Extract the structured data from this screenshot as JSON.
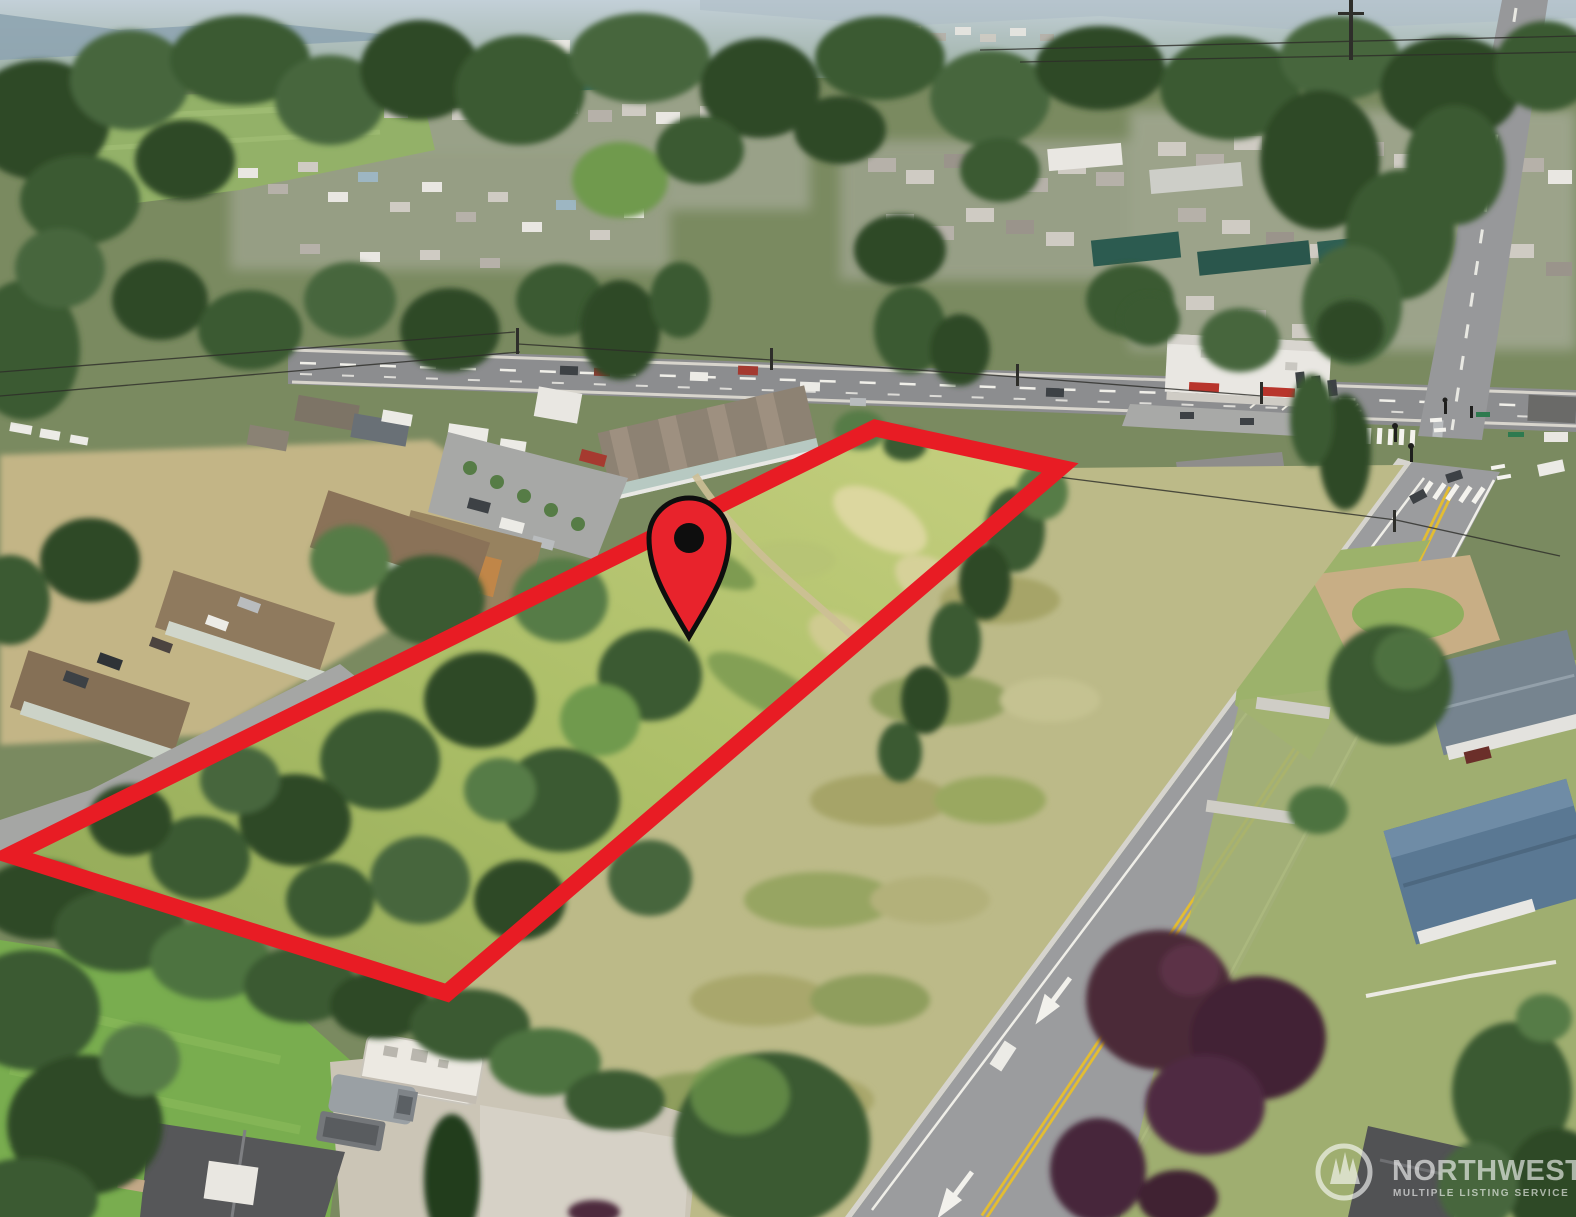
{
  "photo": {
    "kind": "aerial-drone-photograph",
    "subject": "Vacant land parcel outlined in red with a map pin, bordered by townhomes, a state highway and a residential side street in a suburban neighborhood",
    "parcel_terrain_west": "dense trees and brush",
    "parcel_terrain_east": "open grass meadow"
  },
  "overlay": {
    "parcel_boundary": {
      "points": "875,428 1060,468 447,993 10,855",
      "color": "#e81c24",
      "stroke_width": "17"
    },
    "location_pin": {
      "fill": "#e8232c",
      "stroke": "#0e0e0e",
      "dot_color": "#0e0e0e"
    }
  },
  "watermark": {
    "brand": "NORTHWEST",
    "tagline": "MULTIPLE LISTING SERVICE",
    "logo_icon": "three-evergreens-in-circle",
    "text_color": "#ffffff"
  }
}
